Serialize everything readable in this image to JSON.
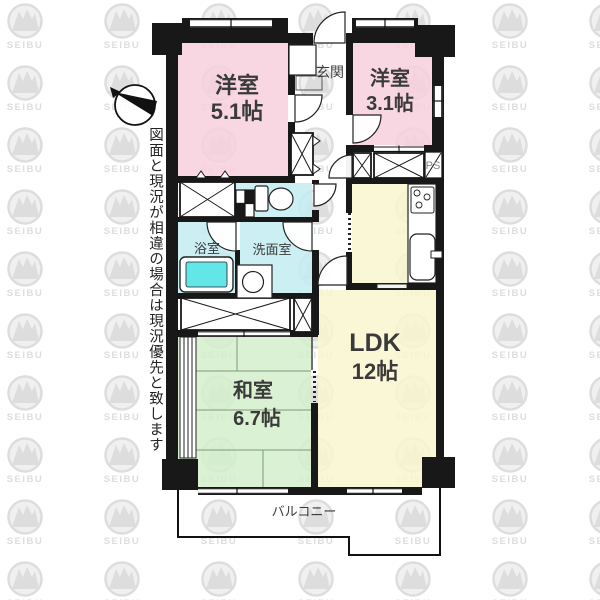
{
  "disclaimer": "図面と現況が相違の場合は現況優先と致します",
  "watermark": {
    "brand": "SEIBU"
  },
  "rooms": {
    "west_room_1": {
      "name": "洋室",
      "size": "5.1帖"
    },
    "west_room_2": {
      "name": "洋室",
      "size": "3.1帖"
    },
    "entrance": {
      "name": "玄関"
    },
    "bathroom": {
      "name": "浴室"
    },
    "washroom": {
      "name": "洗面室"
    },
    "japanese_room": {
      "name": "和室",
      "size": "6.7帖"
    },
    "ldk": {
      "name": "LDK",
      "size": "12帖"
    },
    "pipe_space": {
      "name": "PS"
    },
    "balcony": {
      "name": "バルコニー"
    }
  },
  "colors": {
    "western_room_fill": "#f7cfdd",
    "wet_area_fill": "#c3ecf2",
    "bathtub_fill": "#63e6e8",
    "ldk_fill": "#f9f6cf",
    "tatami_fill": "#d3eecb",
    "wall": "#181818",
    "watermark_gray": "#dddddd"
  }
}
